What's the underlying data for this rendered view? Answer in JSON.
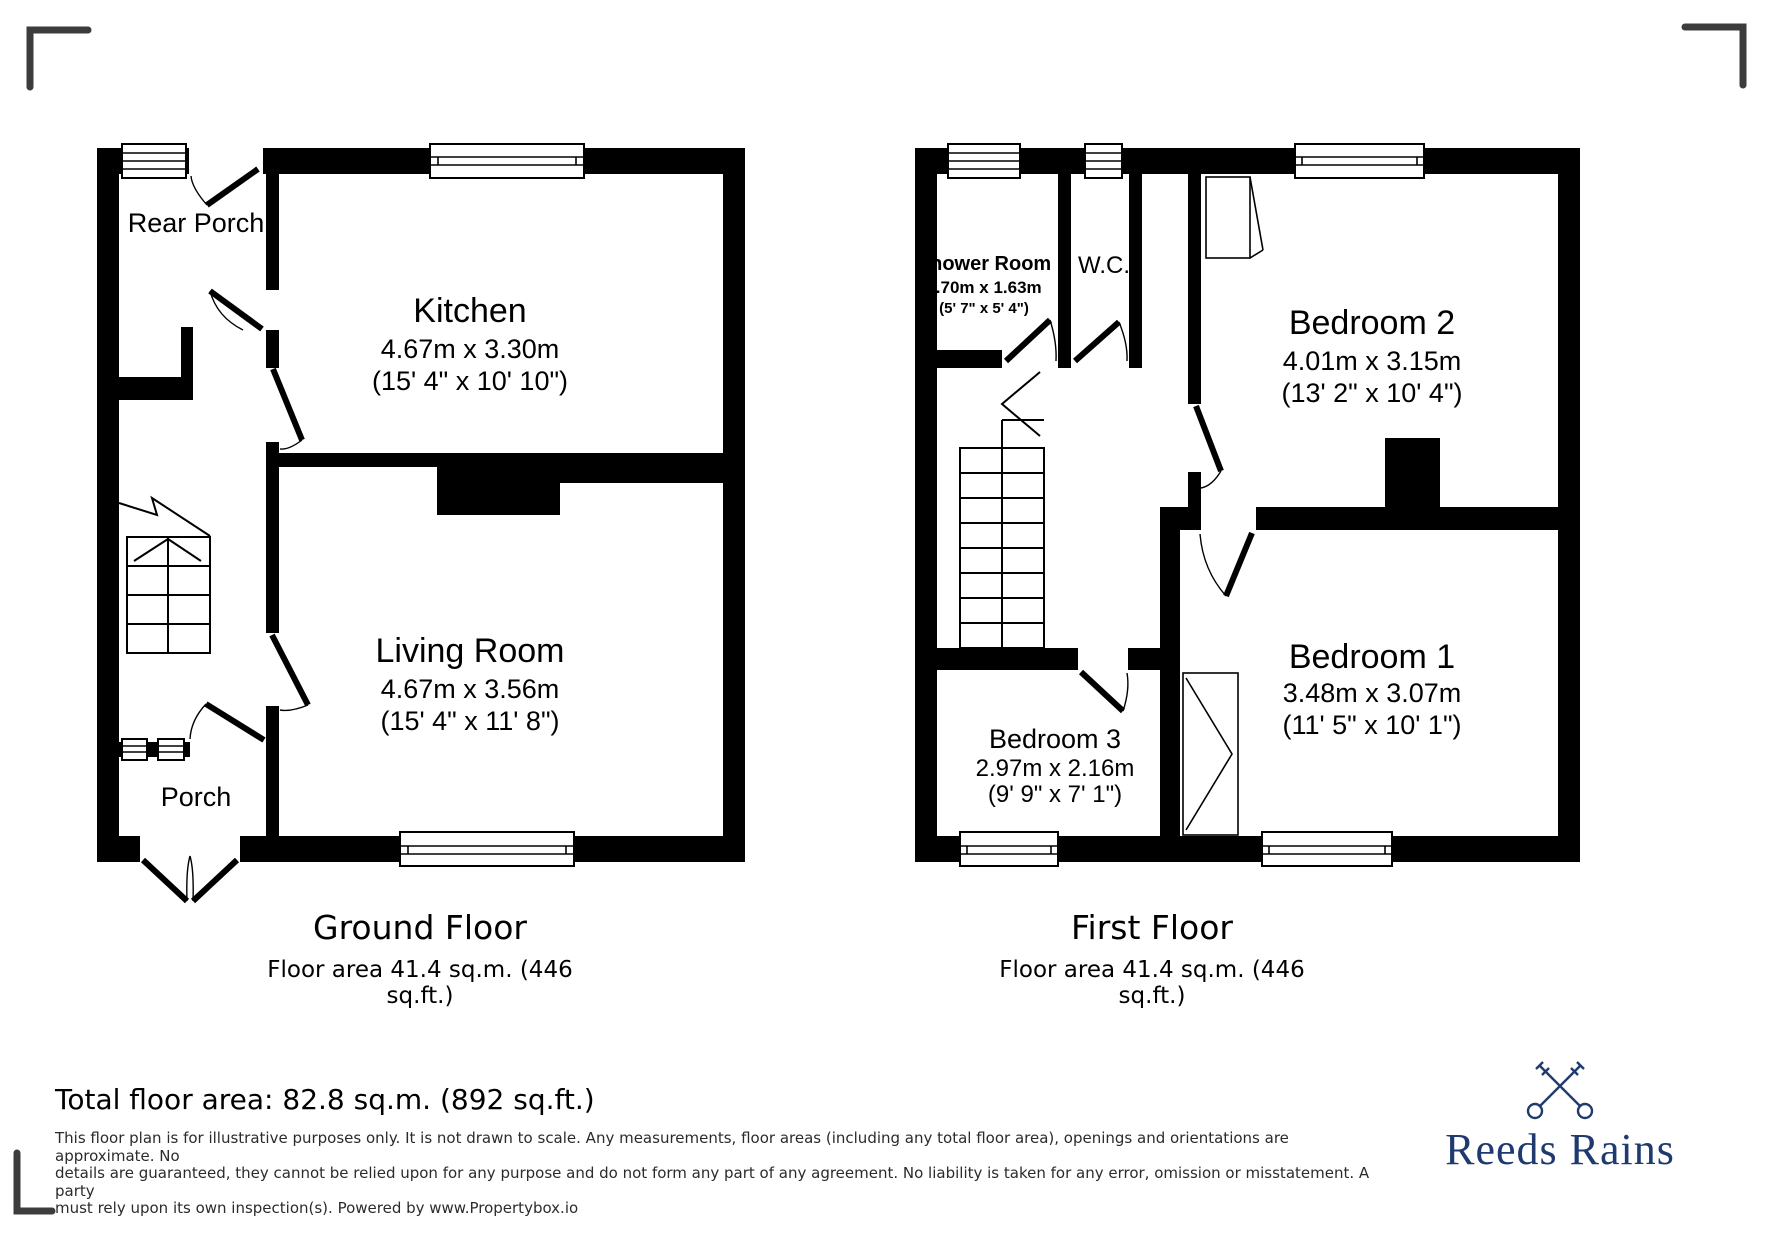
{
  "ground_floor": {
    "title": "Ground Floor",
    "area_label": "Floor area 41.4 sq.m. (446 sq.ft.)",
    "rooms": {
      "rear_porch": {
        "name": "Rear Porch"
      },
      "kitchen": {
        "name": "Kitchen",
        "dims_m": "4.67m x 3.30m",
        "dims_ft": "(15' 4\" x 10' 10\")"
      },
      "living_room": {
        "name": "Living Room",
        "dims_m": "4.67m x 3.56m",
        "dims_ft": "(15' 4\" x 11' 8\")"
      },
      "porch": {
        "name": "Porch"
      }
    }
  },
  "first_floor": {
    "title": "First Floor",
    "area_label": "Floor area 41.4 sq.m. (446 sq.ft.)",
    "rooms": {
      "shower_room": {
        "name": "Shower Room",
        "dims_m": "1.70m x 1.63m",
        "dims_ft": "(5' 7\" x 5' 4\")"
      },
      "wc": {
        "name": "W.C."
      },
      "bedroom2": {
        "name": "Bedroom 2",
        "dims_m": "4.01m x 3.15m",
        "dims_ft": "(13' 2\" x 10' 4\")"
      },
      "bedroom3": {
        "name": "Bedroom 3",
        "dims_m": "2.97m x 2.16m",
        "dims_ft": "(9' 9\" x 7' 1\")"
      },
      "bedroom1": {
        "name": "Bedroom 1",
        "dims_m": "3.48m x 3.07m",
        "dims_ft": "(11' 5\" x 10' 1\")"
      }
    }
  },
  "footer": {
    "total_area": "Total floor area: 82.8 sq.m. (892 sq.ft.)",
    "disclaimer_lines": [
      "This floor plan is for illustrative purposes only. It is not drawn to scale. Any measurements, floor areas (including any total floor area), openings and orientations are approximate. No",
      "details are guaranteed, they cannot be relied upon for any purpose and do not form any part of any agreement. No liability is taken for any error, omission or misstatement. A party",
      "must rely upon its own inspection(s). Powered by www.Propertybox.io"
    ],
    "brand": {
      "name": "Reeds Rains",
      "color": "#1f3a6e",
      "icon": "crossed-keys-icon"
    }
  },
  "colors": {
    "walls": "#000000",
    "background": "#ffffff",
    "crop_marks": "#3c3c3c"
  }
}
